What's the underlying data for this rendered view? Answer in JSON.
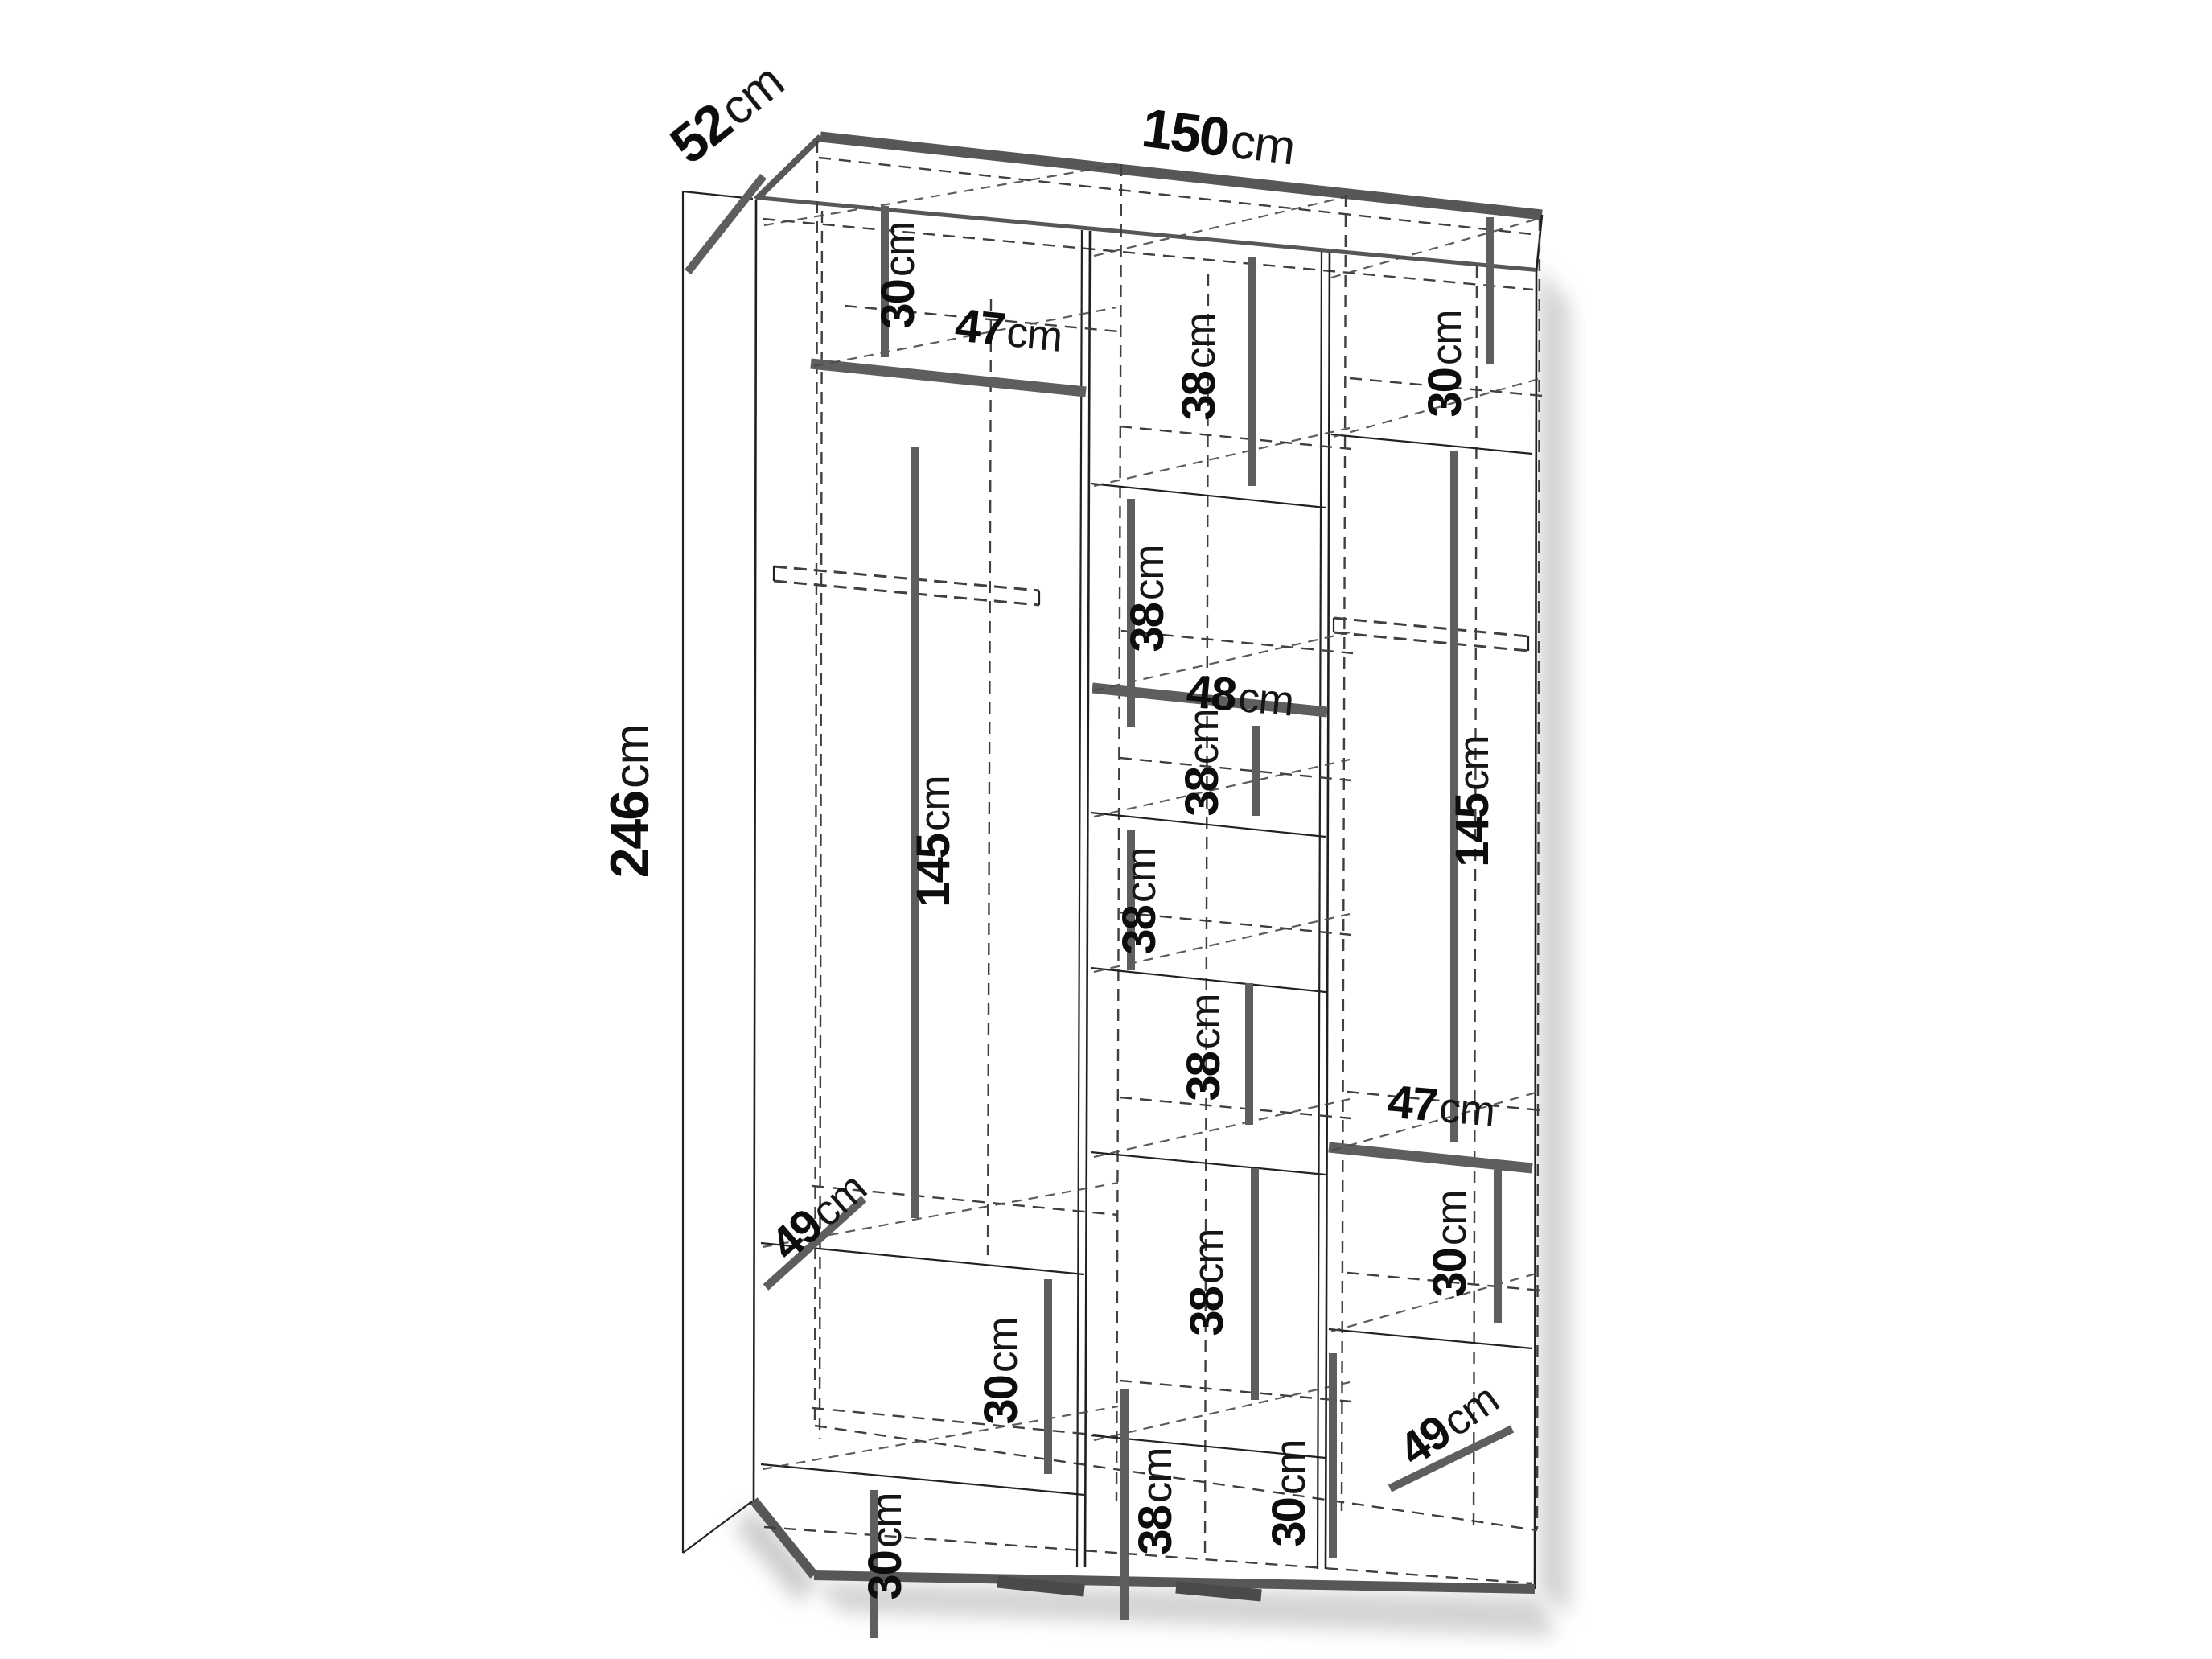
{
  "diagram": {
    "type": "furniture-dimension-diagram",
    "subject": "wardrobe with internal shelves"
  },
  "colors": {
    "line": "#1f1f1f",
    "dimension_bar": "#5e5e5e",
    "dashed_line": "#3f3f3f",
    "text": "#0d0d0d",
    "background": "#ffffff",
    "shadow": "#a8a8a8"
  },
  "dimensions": {
    "width": {
      "value": "150",
      "unit": "cm"
    },
    "depth": {
      "value": "52",
      "unit": "cm"
    },
    "height": {
      "value": "246",
      "unit": "cm"
    },
    "interior": {
      "left_column": [
        {
          "name": "top-compartment-height",
          "value": "30",
          "unit": "cm"
        },
        {
          "name": "top-shelf-width",
          "value": "47",
          "unit": "cm"
        },
        {
          "name": "hanging-section-height",
          "value": "145",
          "unit": "cm"
        },
        {
          "name": "shelf-depth",
          "value": "49",
          "unit": "cm"
        },
        {
          "name": "lower-compartment-height",
          "value": "30",
          "unit": "cm"
        },
        {
          "name": "bottom-compartment-height",
          "value": "30",
          "unit": "cm"
        }
      ],
      "middle_column": [
        {
          "name": "compartment-1-height",
          "value": "38",
          "unit": "cm"
        },
        {
          "name": "compartment-2-height",
          "value": "38",
          "unit": "cm"
        },
        {
          "name": "shelf-width",
          "value": "48",
          "unit": "cm"
        },
        {
          "name": "compartment-3-height",
          "value": "38",
          "unit": "cm"
        },
        {
          "name": "compartment-4-height",
          "value": "38",
          "unit": "cm"
        },
        {
          "name": "compartment-5-height",
          "value": "38",
          "unit": "cm"
        },
        {
          "name": "compartment-6-height",
          "value": "38",
          "unit": "cm"
        },
        {
          "name": "compartment-7-height",
          "value": "38",
          "unit": "cm"
        }
      ],
      "right_column": [
        {
          "name": "top-compartment-height",
          "value": "30",
          "unit": "cm"
        },
        {
          "name": "hanging-section-height",
          "value": "145",
          "unit": "cm"
        },
        {
          "name": "shelf-width",
          "value": "47",
          "unit": "cm"
        },
        {
          "name": "lower-compartment-height",
          "value": "30",
          "unit": "cm"
        },
        {
          "name": "bottom-compartment-height",
          "value": "30",
          "unit": "cm"
        },
        {
          "name": "shelf-depth",
          "value": "49",
          "unit": "cm"
        }
      ]
    }
  }
}
